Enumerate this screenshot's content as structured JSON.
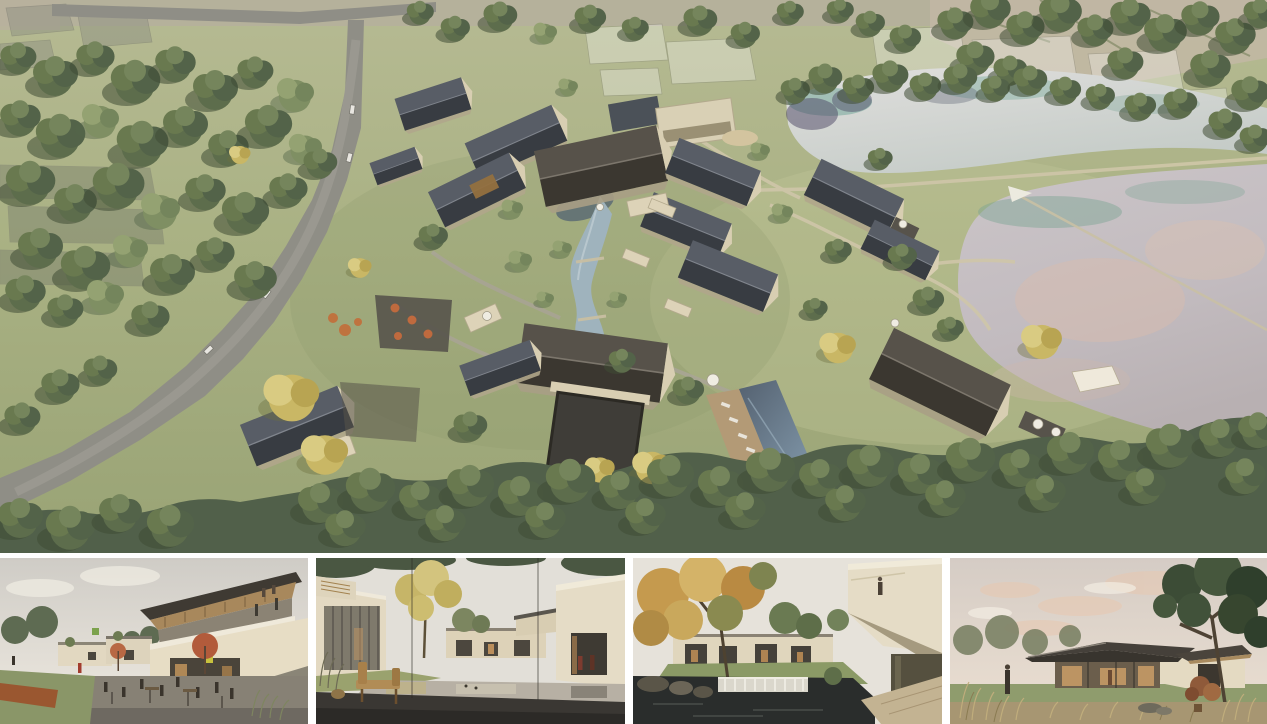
{
  "collage": {
    "main": {
      "name": "aerial-masterplan-view",
      "description": "Aerial rendering of a creekside village resort: dark-roofed houses around a winding stream, swimming pool terrace, curving access road on the left, two large reflective ponds on the right, dense tree belts and ghosted future plots"
    },
    "thumbnails": [
      {
        "name": "street-plaza-view",
        "description": "Street-level plaza with cafe umbrellas, outdoor seating and a two-storey timber-eaved building"
      },
      {
        "name": "courtyard-pond-view",
        "description": "Reflecting-pond courtyard with glass-walled villa, lawn slope and a wooden lounge chair on a dark stone deck"
      },
      {
        "name": "garden-weir-view",
        "description": "Garden court with golden tree, pond weir waterfall and a cantilevered cream volume"
      },
      {
        "name": "dusk-pavilion-view",
        "description": "Single-storey pavilion with broad dark roof and warm glazed facade at dusk, meadow grasses in front"
      }
    ]
  },
  "palette": {
    "background": "#ffffff",
    "grass": "#a9b183",
    "forest_green": "#55654a",
    "roof_slate": "#41454b",
    "wall_cream": "#ddd2b6",
    "pond_silver": "#d6d5d3",
    "pond_mauve": "#c6bdc0",
    "water_teal": "#6fa090",
    "pool_blue": "#5e7081",
    "stream_blue": "#a3b6c0",
    "road_grey": "#8e8d85",
    "path_tan": "#cfc6a9",
    "umbrella_terracotta": "#bf6a3e",
    "deck_wood": "#b39a76",
    "interior_warm": "#c59a66",
    "sky_grey": "#d9d0c7",
    "cloud_pink": "#e8c8b0"
  }
}
